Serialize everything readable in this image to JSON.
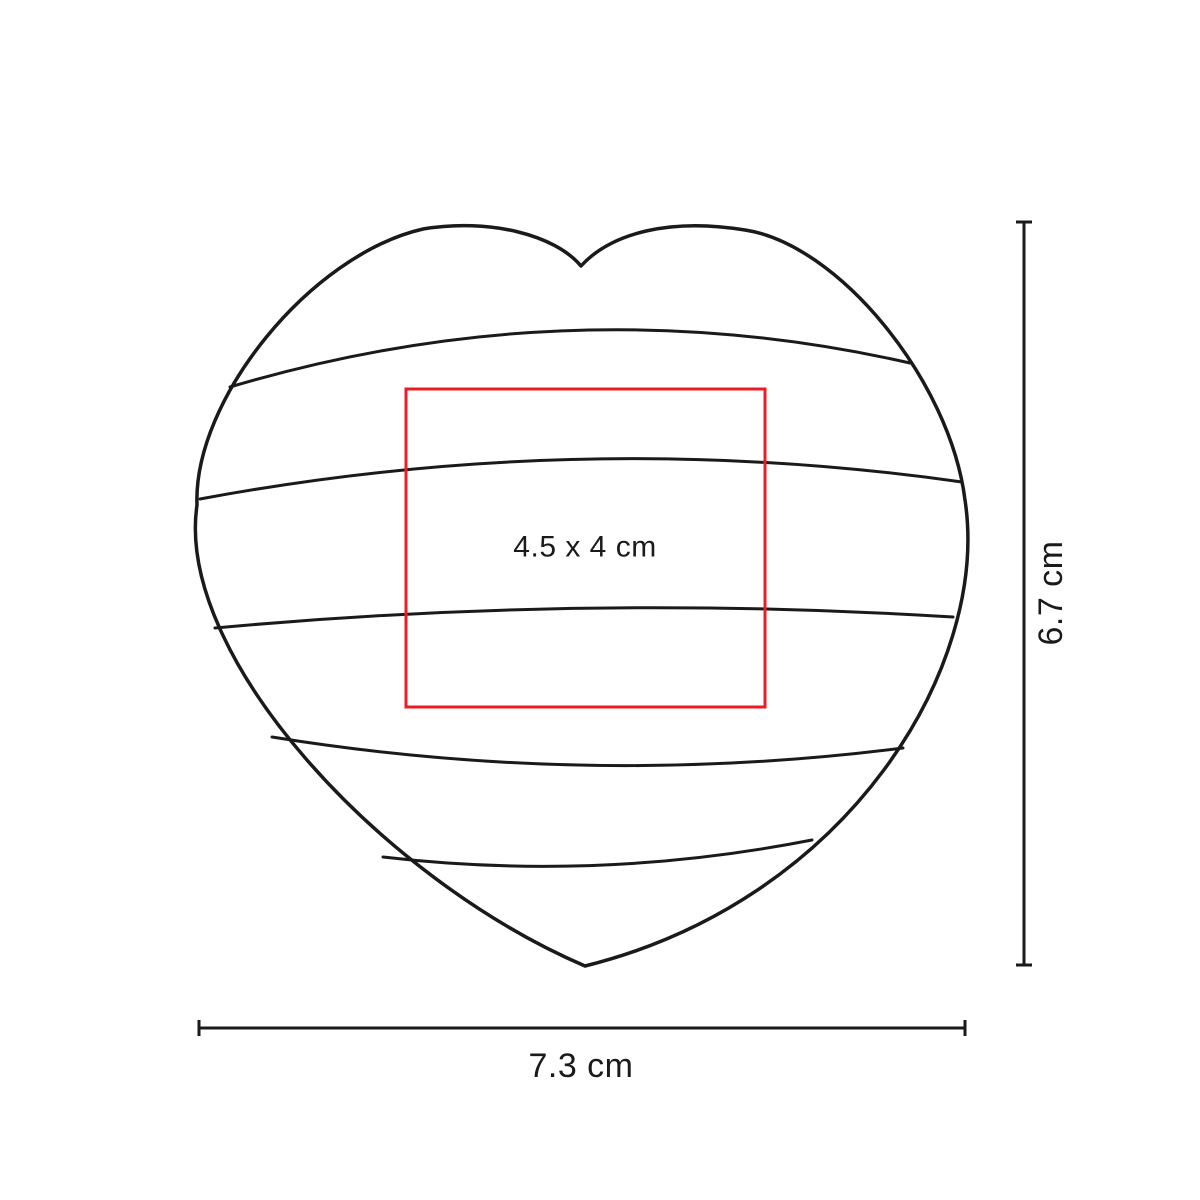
{
  "diagram": {
    "background": "#ffffff",
    "ink_color": "#1a1a1a",
    "print_area": {
      "label": "4.5 x 4 cm",
      "color": "#ec1c24"
    },
    "dimensions": {
      "height": {
        "label": "6.7 cm"
      },
      "width": {
        "label": "7.3 cm"
      }
    }
  }
}
